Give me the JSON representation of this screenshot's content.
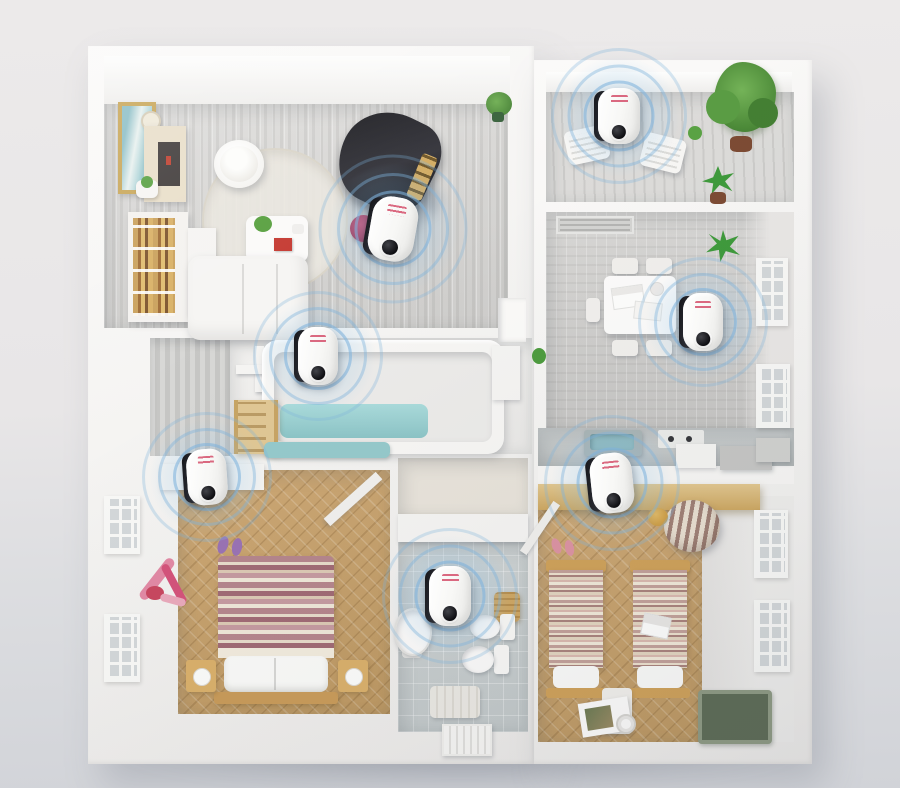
{
  "scene": {
    "type": "3d-floorplan-product-render",
    "description": "Top-down 3D cutaway floor plan of an apartment with seven plug-in ultrasonic pest repeller devices, one per room, each emitting concentric blue ultrasonic wave rings.",
    "device_count": 7
  },
  "palette": {
    "background_top": "#eceaea",
    "background_bottom": "#d1d3d8",
    "wall_white": "#f8f7f5",
    "floor_gray_wood": "#d6d5d3",
    "floor_tan_wood": "#c9a46f",
    "floor_tile": "#c9cfcf",
    "bath_water_teal": "#9ed0d1",
    "ultrasonic_ring_blue": "#7fb3dc",
    "device_body_white": "#f8f8f6",
    "device_side_black": "#1d1e23",
    "device_logo_red": "#d65570",
    "plant_green": "#58a03f",
    "accent_red": "#c43a50"
  },
  "rooms": [
    {
      "id": "living-room",
      "name": "Living room",
      "floor": "gray wood planks",
      "contents": [
        "grand piano",
        "sofa",
        "round rug",
        "bean bag",
        "coffee table",
        "bookshelf",
        "media cabinet",
        "picture frame",
        "wall clock",
        "potted plants",
        "red stool"
      ]
    },
    {
      "id": "balcony",
      "name": "Balcony",
      "floor": "gray wood slats",
      "contents": [
        "two lounge chairs",
        "large potted plant",
        "aloe plant",
        "small pots"
      ]
    },
    {
      "id": "dining-room",
      "name": "Dining room",
      "floor": "gray wood planks",
      "contents": [
        "dining table with papers",
        "four chairs",
        "wall plant",
        "two lattice windows",
        "ceiling vent"
      ]
    },
    {
      "id": "bathroom",
      "name": "Bathroom with tub",
      "floor": "light stone",
      "contents": [
        "bathtub with water",
        "towel cross rack",
        "wooden ladder shelf",
        "striped wall paneling",
        "teal bath mat",
        "hall cabinet"
      ]
    },
    {
      "id": "master-bedroom",
      "name": "Master bedroom",
      "floor": "herringbone wood",
      "contents": [
        "double bed with striped blanket",
        "two nightstands with lamps",
        "pink exercise gear",
        "two lattice windows",
        "wall shelf",
        "slippers"
      ]
    },
    {
      "id": "toilet",
      "name": "Toilet room",
      "floor": "gray tile",
      "contents": [
        "sink",
        "two toilets",
        "laundry basket",
        "bath mat",
        "radiator"
      ]
    },
    {
      "id": "kids-bedroom",
      "name": "Kids bedroom",
      "floor": "herringbone wood",
      "contents": [
        "two twin beds",
        "striped bean bag",
        "yellow pouf",
        "green rug",
        "magazine",
        "two lattice windows",
        "slippers"
      ]
    },
    {
      "id": "kitchen",
      "name": "Kitchen counter",
      "floor": "counter band",
      "contents": [
        "teal sink unit",
        "outlet panel",
        "appliances",
        "wooden ledge"
      ]
    }
  ],
  "devices": [
    {
      "id": "living-room",
      "room": "Living room",
      "x": 393,
      "y": 229,
      "w": 46,
      "h": 64,
      "tilt": 10
    },
    {
      "id": "balcony",
      "room": "Balcony",
      "x": 619,
      "y": 116,
      "w": 42,
      "h": 56,
      "tilt": 0
    },
    {
      "id": "dining-room",
      "room": "Dining room",
      "x": 703,
      "y": 322,
      "w": 40,
      "h": 58,
      "tilt": 0
    },
    {
      "id": "bathroom",
      "room": "Bathroom",
      "x": 318,
      "y": 356,
      "w": 40,
      "h": 58,
      "tilt": 0
    },
    {
      "id": "master-bedroom",
      "room": "Master bedroom",
      "x": 207,
      "y": 477,
      "w": 40,
      "h": 56,
      "tilt": -4
    },
    {
      "id": "toilet",
      "room": "Toilet room",
      "x": 450,
      "y": 596,
      "w": 42,
      "h": 60,
      "tilt": 0
    },
    {
      "id": "kids-bedroom",
      "room": "Kids bedroom",
      "x": 612,
      "y": 483,
      "w": 42,
      "h": 60,
      "tilt": -6
    }
  ],
  "device_style": {
    "rings_per_device": 3,
    "label_color": "#d65570"
  }
}
